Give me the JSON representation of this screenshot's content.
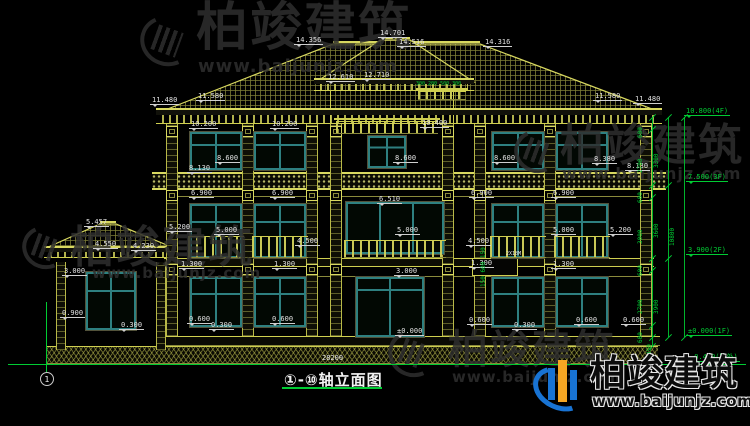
{
  "drawing": {
    "title": "①-⑩轴立面图",
    "axis_start": "1",
    "overall_width_dim": "28200"
  },
  "watermark": {
    "brand": "柏竣建筑",
    "site": "www.baijunjz.com"
  },
  "palette": {
    "line_yellow": "#cfcf50",
    "window_teal": "#2e8080",
    "dim_green": "#00cc33",
    "logo_blue": "#1873d3",
    "logo_orange": "#f5a623"
  },
  "annotations": {
    "white": [
      {
        "t": "14.356",
        "x": 294,
        "y": 36
      },
      {
        "t": "14.701",
        "x": 378,
        "y": 29
      },
      {
        "t": "14.516",
        "x": 397,
        "y": 38
      },
      {
        "t": "14.316",
        "x": 483,
        "y": 38
      },
      {
        "t": "12.610",
        "x": 326,
        "y": 73
      },
      {
        "t": "12.710",
        "x": 362,
        "y": 71
      },
      {
        "t": "11.480",
        "x": 150,
        "y": 96
      },
      {
        "t": "11.580",
        "x": 196,
        "y": 92
      },
      {
        "t": "11.580",
        "x": 593,
        "y": 92
      },
      {
        "t": "11.480",
        "x": 633,
        "y": 95
      },
      {
        "t": "10.200",
        "x": 189,
        "y": 120
      },
      {
        "t": "10.200",
        "x": 270,
        "y": 120
      },
      {
        "t": "10.400",
        "x": 420,
        "y": 119
      },
      {
        "t": "8.600",
        "x": 215,
        "y": 154
      },
      {
        "t": "8.130",
        "x": 187,
        "y": 164
      },
      {
        "t": "8.600",
        "x": 393,
        "y": 154
      },
      {
        "t": "8.600",
        "x": 492,
        "y": 154
      },
      {
        "t": "8.380",
        "x": 592,
        "y": 155
      },
      {
        "t": "8.130",
        "x": 625,
        "y": 162
      },
      {
        "t": "6.900",
        "x": 189,
        "y": 189
      },
      {
        "t": "6.900",
        "x": 270,
        "y": 189
      },
      {
        "t": "6.510",
        "x": 377,
        "y": 195
      },
      {
        "t": "6.900",
        "x": 469,
        "y": 189
      },
      {
        "t": "6.900",
        "x": 551,
        "y": 189
      },
      {
        "t": "5.457",
        "x": 84,
        "y": 218
      },
      {
        "t": "4.550",
        "x": 93,
        "y": 240
      },
      {
        "t": "4.230",
        "x": 131,
        "y": 242
      },
      {
        "t": "5.200",
        "x": 167,
        "y": 223
      },
      {
        "t": "5.000",
        "x": 214,
        "y": 226
      },
      {
        "t": "4.500",
        "x": 295,
        "y": 237
      },
      {
        "t": "5.000",
        "x": 395,
        "y": 226
      },
      {
        "t": "4.500",
        "x": 466,
        "y": 237
      },
      {
        "t": "5.000",
        "x": 551,
        "y": 226
      },
      {
        "t": "5.200",
        "x": 608,
        "y": 226
      },
      {
        "t": "1.300",
        "x": 179,
        "y": 260
      },
      {
        "t": "1.300",
        "x": 272,
        "y": 260
      },
      {
        "t": "1.300",
        "x": 469,
        "y": 259
      },
      {
        "t": "1.300",
        "x": 551,
        "y": 260
      },
      {
        "t": "3.000",
        "x": 62,
        "y": 267
      },
      {
        "t": "3.000",
        "x": 394,
        "y": 267
      },
      {
        "t": "0.900",
        "x": 60,
        "y": 309
      },
      {
        "t": "0.300",
        "x": 119,
        "y": 321
      },
      {
        "t": "0.600",
        "x": 187,
        "y": 315
      },
      {
        "t": "0.300",
        "x": 209,
        "y": 321
      },
      {
        "t": "0.600",
        "x": 270,
        "y": 315
      },
      {
        "t": "0.600",
        "x": 467,
        "y": 316
      },
      {
        "t": "0.300",
        "x": 512,
        "y": 321
      },
      {
        "t": "0.600",
        "x": 574,
        "y": 316
      },
      {
        "t": "0.600",
        "x": 621,
        "y": 316
      },
      {
        "t": "±0.000",
        "x": 395,
        "y": 327
      },
      {
        "t": "28200",
        "x": 320,
        "y": 354,
        "p": 1
      },
      {
        "t": "2X18M",
        "x": 504,
        "y": 250,
        "p": 1,
        "s": 5
      }
    ],
    "green": [
      {
        "t": "10.800(4F)",
        "x": 684,
        "y": 107
      },
      {
        "t": "7.500(3F)",
        "x": 686,
        "y": 173
      },
      {
        "t": "3.900(2F)",
        "x": 686,
        "y": 246
      },
      {
        "t": "±0.000(1F)",
        "x": 686,
        "y": 327
      },
      {
        "t": "-0.450(室外)",
        "x": 688,
        "y": 353
      },
      {
        "t": "300 200 500 300",
        "x": 414,
        "y": 80,
        "p": 1,
        "s": 5
      }
    ],
    "chain": [
      {
        "t": "600",
        "x": 645,
        "y": 132
      },
      {
        "t": "2700",
        "x": 645,
        "y": 167
      },
      {
        "t": "600",
        "x": 645,
        "y": 197
      },
      {
        "t": "3000",
        "x": 645,
        "y": 238
      },
      {
        "t": "600",
        "x": 645,
        "y": 270
      },
      {
        "t": "2700",
        "x": 645,
        "y": 308
      },
      {
        "t": "600",
        "x": 645,
        "y": 337
      },
      {
        "t": "450",
        "x": 654,
        "y": 349
      },
      {
        "t": "3300",
        "x": 661,
        "y": 162
      },
      {
        "t": "3600",
        "x": 661,
        "y": 232
      },
      {
        "t": "3900",
        "x": 661,
        "y": 308
      },
      {
        "t": "10800",
        "x": 677,
        "y": 240
      },
      {
        "t": "150 600 150",
        "x": 488,
        "y": 281
      }
    ],
    "ticks": [
      {
        "x": 648,
        "y": 117
      },
      {
        "x": 648,
        "y": 129
      },
      {
        "x": 648,
        "y": 185
      },
      {
        "x": 648,
        "y": 197
      },
      {
        "x": 648,
        "y": 258
      },
      {
        "x": 648,
        "y": 270
      },
      {
        "x": 648,
        "y": 325
      },
      {
        "x": 648,
        "y": 337
      },
      {
        "x": 648,
        "y": 346
      },
      {
        "x": 664,
        "y": 117
      },
      {
        "x": 664,
        "y": 185
      },
      {
        "x": 664,
        "y": 258
      },
      {
        "x": 664,
        "y": 337
      },
      {
        "x": 680,
        "y": 117
      },
      {
        "x": 680,
        "y": 337
      }
    ]
  }
}
